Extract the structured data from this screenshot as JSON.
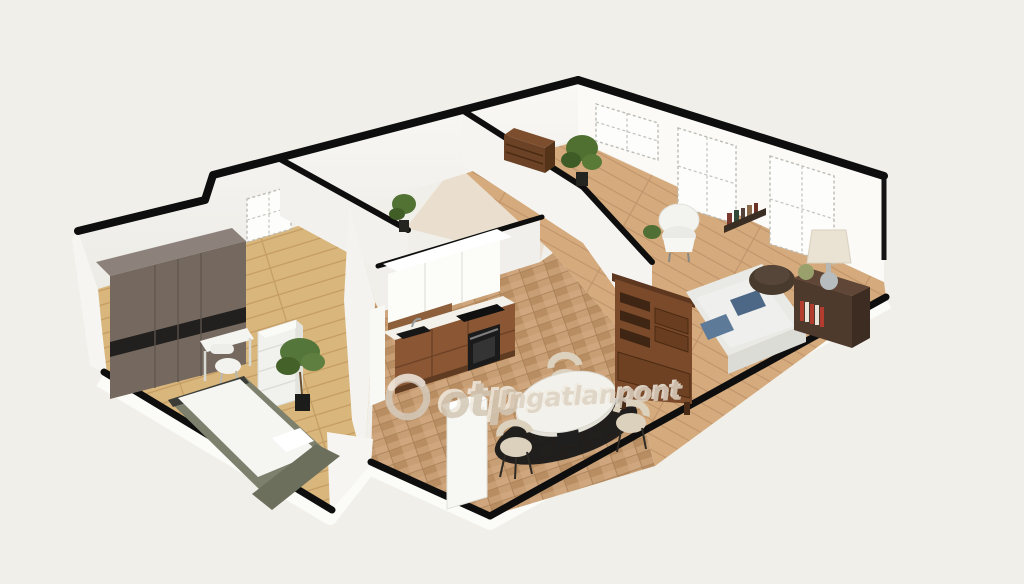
{
  "watermark": {
    "logo": "otp-ring-logo",
    "brand": "otp",
    "suffix": "Ingatlanpont"
  },
  "palette": {
    "bg": "#f0efe9",
    "cap": "#0e0e0e",
    "wall": "#f6f5f2",
    "wall-shade": "#edebe6",
    "bedroom-floor": "#d9b67c",
    "kitchen-floor": "#c89e74",
    "living-floor": "#d5ab7d",
    "back-floor": "#eadfce",
    "wardrobe": "#75695f",
    "bed-frame": "#7c806c",
    "mattress": "#f5f5f2",
    "kitchen-wood": "#8a5634",
    "appliance": "#161616",
    "counter": "#f3f1ea",
    "chair-cream": "#dcd1bd",
    "rug": "#181818",
    "hutch": "#7b4a2a",
    "sofa": "#eff0ed",
    "pillow-blue": "#4d6787",
    "pouf": "#483a2c",
    "sideboard": "#4e3a2d",
    "plant": "#55763a",
    "watermark": "#d5cabc"
  },
  "scene": {
    "type": "isometric-3d-floor-plan",
    "rooms": [
      {
        "name": "bedroom",
        "furniture": [
          "wardrobe",
          "single-bed",
          "dresser",
          "desk",
          "desk-chair",
          "potted-plant"
        ]
      },
      {
        "name": "back-hall",
        "furniture": [
          "window"
        ]
      },
      {
        "name": "back-room",
        "furniture": [
          "brown-cabinet",
          "potted-plant",
          "potted-plant"
        ]
      },
      {
        "name": "kitchen-dining",
        "furniture": [
          "upper-cabinets",
          "counter",
          "sink",
          "cooktop",
          "oven",
          "refrigerator",
          "round-dining-table",
          "dining-chair",
          "dining-chair",
          "dining-chair",
          "black-round-rug"
        ]
      },
      {
        "name": "living-room",
        "furniture": [
          "display-hutch",
          "sofa",
          "blue-pillows",
          "pouf",
          "sideboard",
          "table-lamp",
          "vase",
          "armchair",
          "wall-shelf-with-books",
          "windows"
        ]
      }
    ]
  }
}
